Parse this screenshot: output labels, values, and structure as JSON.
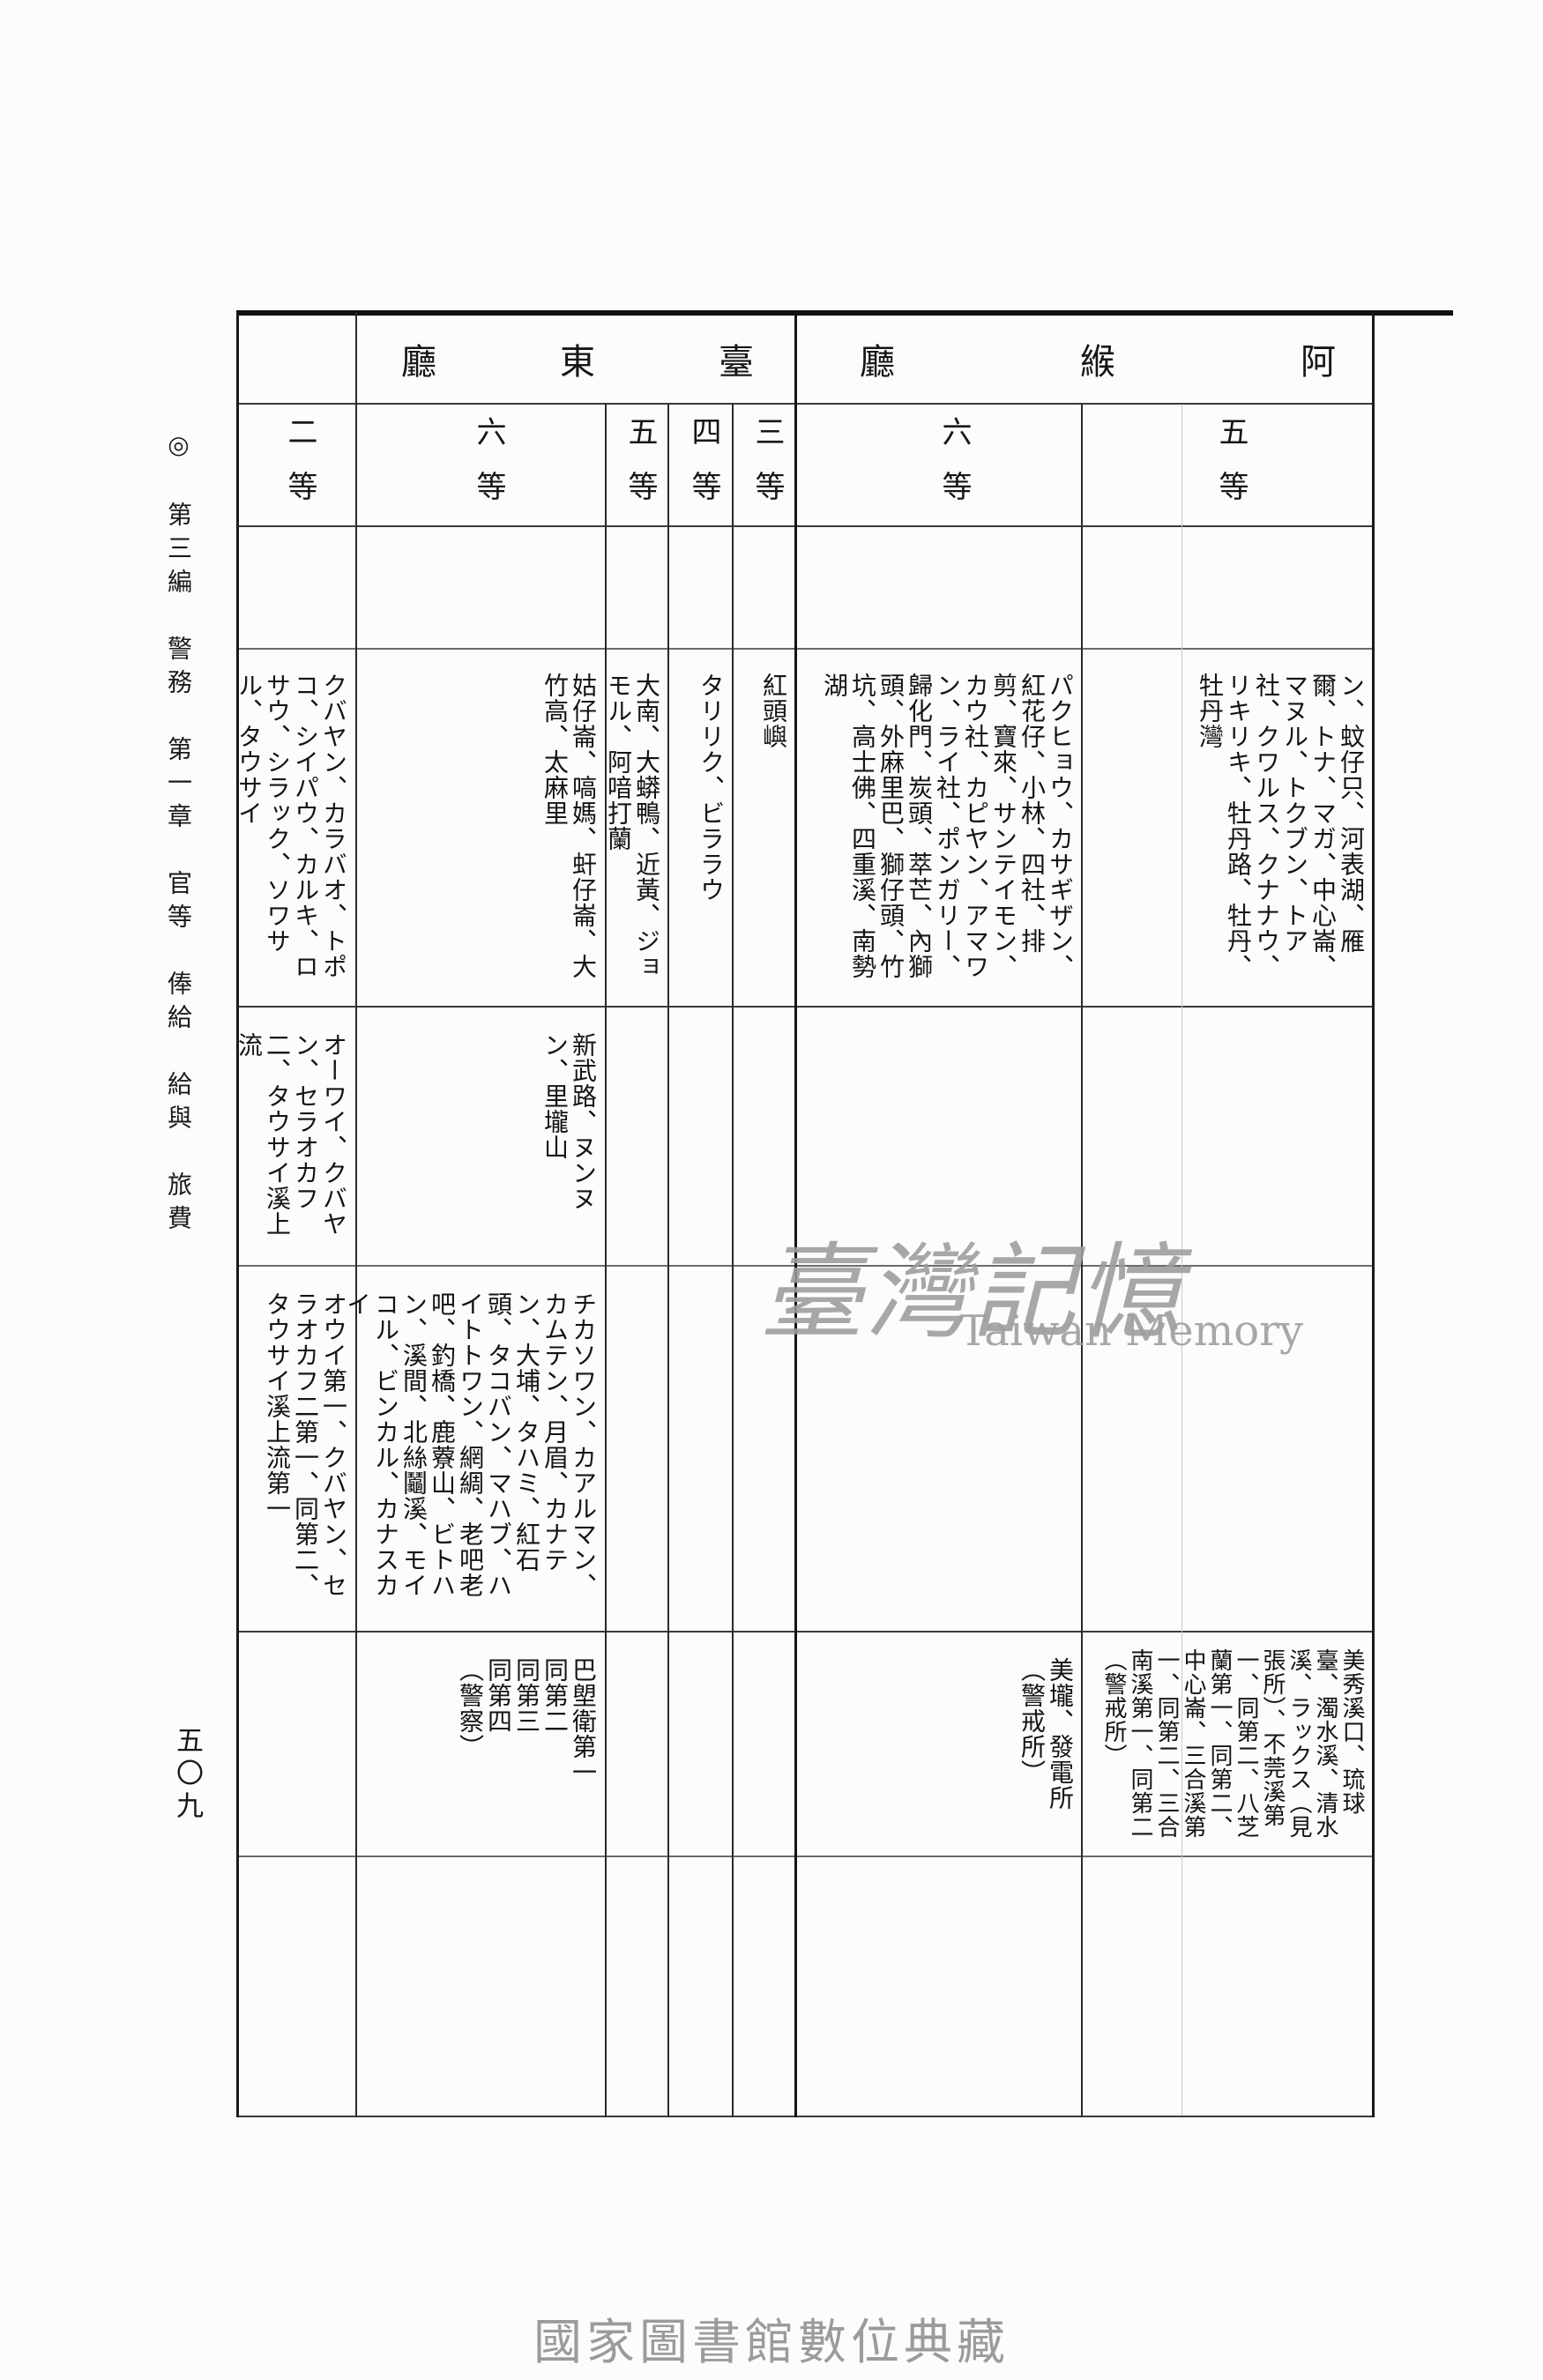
{
  "page": {
    "margin_note": "◎　第三編　警務　第一章　官等　俸給　給與　旅費",
    "page_number": "五〇九",
    "watermark_cjk": "臺灣記憶",
    "watermark_latin": "Taiwan Memory",
    "footer_caption": "國家圖書館數位典藏"
  },
  "table": {
    "section_headers": {
      "taito": {
        "title": "臺東廳",
        "display": "廳東臺"
      },
      "ako": {
        "title": "阿緱廳",
        "display": "廳緱阿"
      }
    },
    "ranks": {
      "taito_2": "二等",
      "taito_6": "六等",
      "taito_5": "五等",
      "taito_4": "四等",
      "taito_3": "三等",
      "ako_6": "六等",
      "ako_5": "五等"
    },
    "cells": {
      "row1": {
        "taito_2": "クバヤン、カラバオ、トポコ、シイパウ、カルキ、ロサウ、シラック、ソワサル、タウサイ",
        "taito_6": "姑仔崙、嗃媽、虷仔崙、大竹高、太麻里",
        "taito_5": "大南、大蟒鴨、近黃、ジョモル、阿喑打蘭",
        "taito_4": "タリリク、ビララウ",
        "taito_3": "紅頭嶼",
        "ako_6": "パクヒョウ、カサギザン、紅花仔、小林、四社、排剪、寶來、サンテイモン、カウ社、カピヤン、アマワン、ライ社、ポンガリー、歸化門、炭頭、萃芒、內獅頭、外麻里巴、獅仔頭、竹坑、高士佛、四重溪、南勢湖",
        "ako_5": "ン、蚊仔只、河表湖、雁爾、トナ、マガ、中心崙、マヌル、トクブン、トア社、クワルス、クナナウ、リキリキ、牡丹路、牡丹、牡丹灣"
      },
      "row2": {
        "taito_2": "オーワイ、クバヤン、セラオカフ二、タウサイ溪上流",
        "taito_6": "新武路、ヌンヌン、里壠山"
      },
      "row3": {
        "taito_2": "オウイ第一、クバヤン、セラオカフ二第一、同第二、タウサイ溪上流第一",
        "taito_6": "チカソワン、カアルマン、カムテン、月眉、カナテン、大埔、タハミ、紅石頭、タコバン、マハブ、ハイトトワン、網綢、老吧老吧、釣橋、鹿藔山、ビトハン、溪間、北絲鬮溪、モイコル、ビンカル、カナスカイ"
      },
      "row4": {
        "taito_6": "巴塱衛第一\n同第二\n同第三\n同第四\n（警察）",
        "ako_6": "美壠、發電所\n（警戒所）",
        "ako_5": "美秀溪口、琉球臺、濁水溪、清水溪、ラックス（見張所）、不莞溪第一、同第二、八芝蘭第一、同第二、中心崙、三合溪第一、同第二、三合南溪第一、同第二（警戒所）"
      }
    }
  }
}
